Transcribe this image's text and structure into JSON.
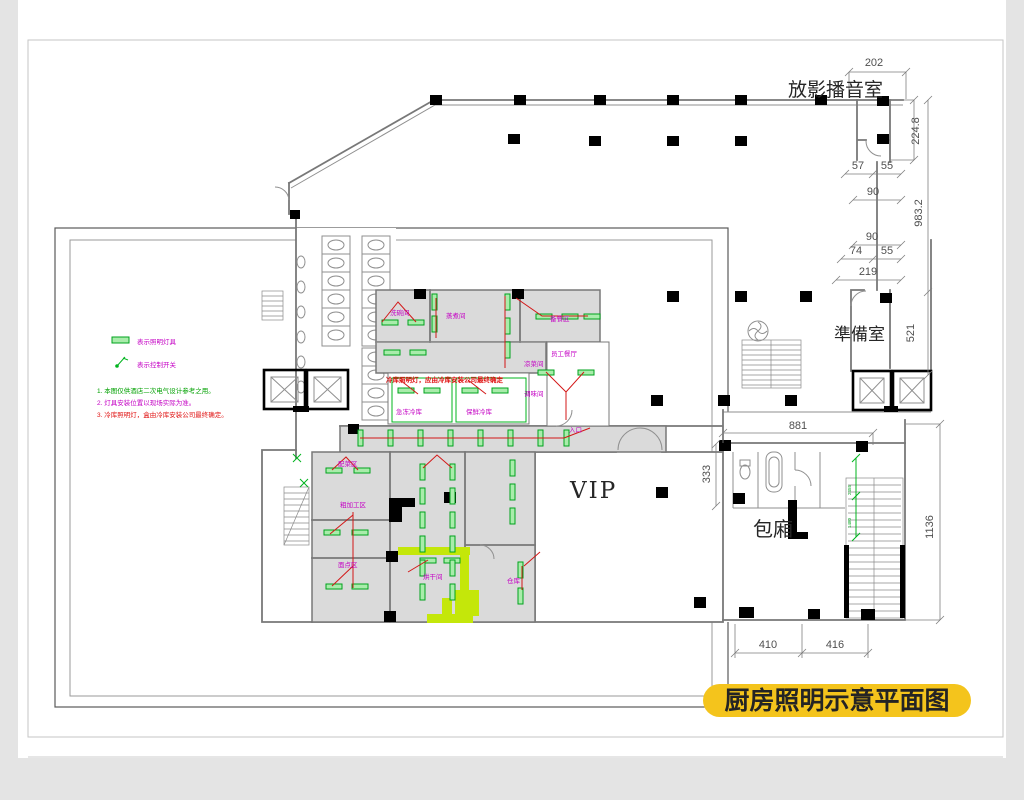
{
  "title": {
    "pill_label": "厨房照明示意平面图"
  },
  "room_labels": {
    "projection_room": "放影播音室",
    "prep_room": "準備室",
    "vip": "VIP",
    "private_room": "包廂",
    "entrance": "入口",
    "dishwash": "洗碗间",
    "steaming": "蒸煮间",
    "food_prep_area": "备餐区",
    "cold_dish": "凉菜间",
    "staff_dining": "员工餐厅",
    "seasoning": "调味间",
    "freezer": "急冻冷库",
    "fresh_cold": "保鲜冷库",
    "veg_prep": "配菜区",
    "rough_prep": "粗加工区",
    "pastry": "面点区",
    "drying_room": "烘干间",
    "storage": "仓库"
  },
  "legend": {
    "light_fixture": "表示照明灯具",
    "control_switch": "表示控制开关"
  },
  "notes": [
    "1. 本图仅供酒店二次电气设计参考之用。",
    "2. 灯具安装位置以现场实际为准。",
    "3. 冷库照明灯，盒由冷库安装公司最终确定。"
  ],
  "plan_note": "冷库照明灯，应由冷库安装公司最终确定",
  "dimensions": {
    "d202": "202",
    "d224_8": "224.8",
    "d57": "57",
    "d55a": "55",
    "d90a": "90",
    "d983_2": "983.2",
    "d90b": "90",
    "d74": "74",
    "d55b": "55",
    "d219": "219",
    "d521": "521",
    "d881": "881",
    "d333": "333",
    "d1136": "1136",
    "d410": "410",
    "d416": "416",
    "g2455": "2455",
    "g1480": "1480"
  },
  "colors": {
    "title_highlight": "#f4c41c",
    "lamp_green": "#00a31c",
    "wire_red": "#d31717",
    "label_magenta": "#c400c4",
    "note_green": "#00a000",
    "note_red": "#e01010",
    "chartreuse": "#c4e70a"
  }
}
